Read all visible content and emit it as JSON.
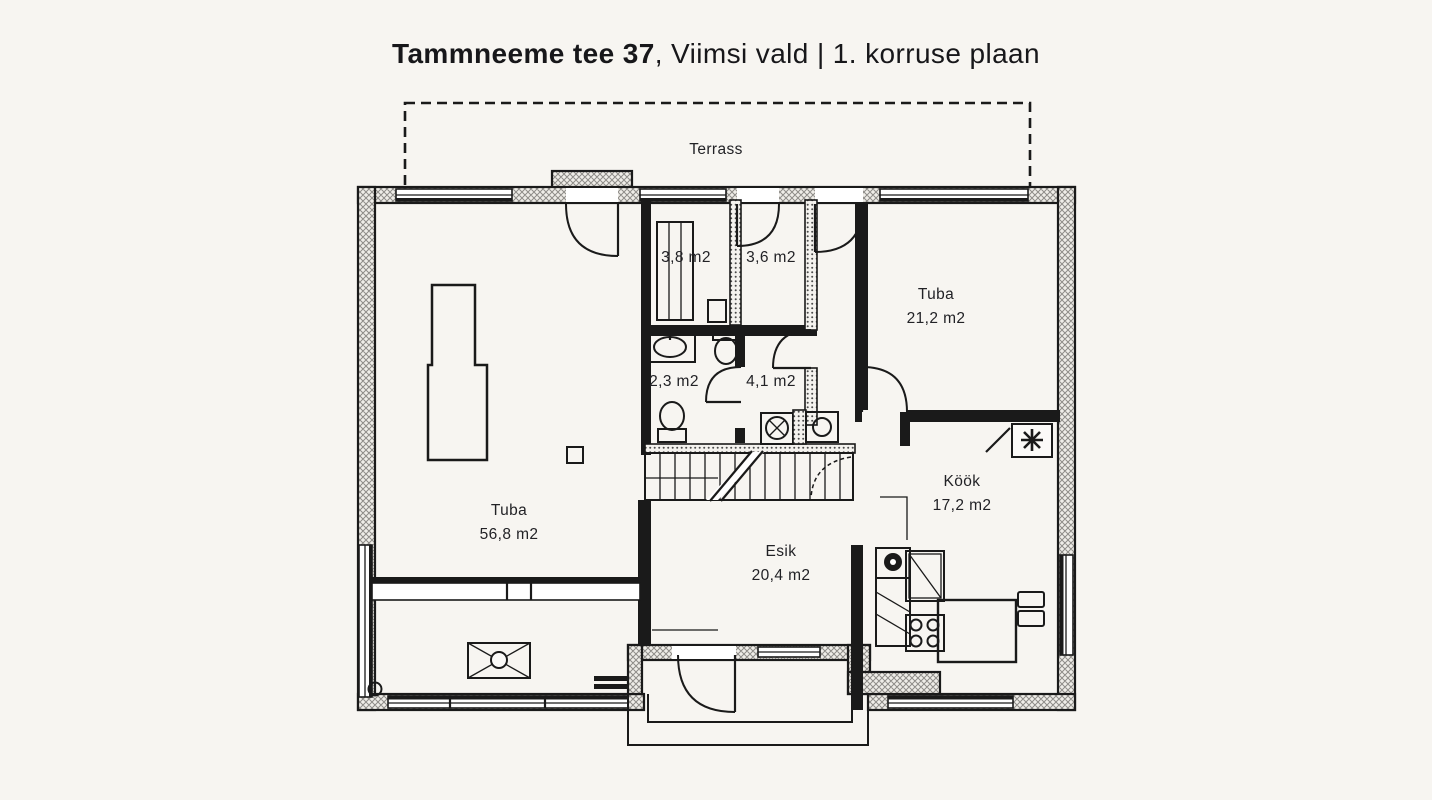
{
  "title": {
    "address_bold": "Tammneeme tee 37",
    "suffix": ", Viimsi vald | 1. korruse plaan"
  },
  "floorplan": {
    "terrace": {
      "label": "Terrass"
    },
    "rooms": [
      {
        "key": "living-room",
        "name": "Tuba",
        "area": "56,8 m2"
      },
      {
        "key": "closet",
        "name": "",
        "area": "3,8 m2"
      },
      {
        "key": "small-room",
        "name": "",
        "area": "3,6 m2"
      },
      {
        "key": "bedroom",
        "name": "Tuba",
        "area": "21,2 m2"
      },
      {
        "key": "wc",
        "name": "",
        "area": "2,3 m2"
      },
      {
        "key": "bathroom",
        "name": "",
        "area": "4,1 m2"
      },
      {
        "key": "kitchen",
        "name": "Köök",
        "area": "17,2 m2"
      },
      {
        "key": "hallway",
        "name": "Esik",
        "area": "20,4 m2"
      }
    ],
    "symbols": [
      {
        "key": "chimney-star",
        "meaning": "chimney/flue symbol"
      }
    ]
  },
  "colors": {
    "background": "#f7f5f1",
    "line": "#1a1a1a"
  }
}
